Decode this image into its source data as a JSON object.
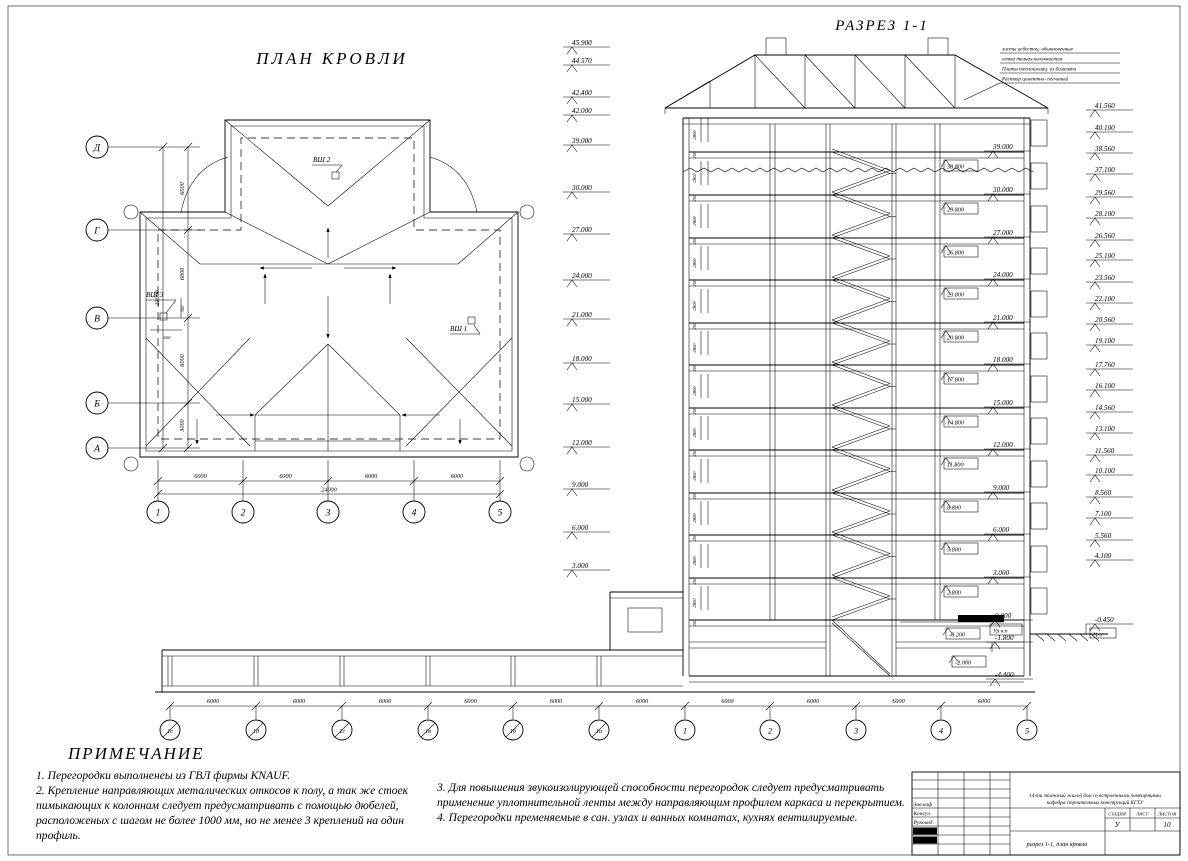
{
  "plan": {
    "title": "ПЛАН КРОВЛИ",
    "axes_left": [
      "Д",
      "Г",
      "В",
      "Б",
      "А"
    ],
    "dims_left": [
      "6000",
      "6000",
      "6000",
      "3000"
    ],
    "total_left": "21000",
    "axes_bottom": [
      "1",
      "2",
      "3",
      "4",
      "5"
    ],
    "dims_bottom": [
      "6000",
      "6000",
      "6000",
      "6000"
    ],
    "total_bottom": "24000",
    "shafts": {
      "vsh1": "ВШ 1",
      "vsh2": "ВШ 2",
      "vsh3": "ВШ 3",
      "dim_300": "300",
      "dim_600": "600"
    }
  },
  "section": {
    "title": "РАЗРЕЗ 1-1",
    "left_marks": [
      "45.900",
      "44.570",
      "42.400",
      "42.000",
      "39.000",
      "30.000",
      "27.000",
      "24.000",
      "21.000",
      "18.000",
      "15.000",
      "12.000",
      "9.000",
      "6.000",
      "3.000"
    ],
    "right_marks": [
      "41.560",
      "40.100",
      "38.560",
      "37.100",
      "29.560",
      "28.100",
      "26.560",
      "25.100",
      "23.560",
      "22.100",
      "20.560",
      "19.100",
      "17.760",
      "16.100",
      "14.560",
      "13.100",
      "11.560",
      "10.100",
      "8.560",
      "7.100",
      "5.560",
      "4.100"
    ],
    "floor_marks": [
      "39.000",
      "30.000",
      "27.000",
      "24.000",
      "21.000",
      "18.000",
      "15.000",
      "12.000",
      "9.000",
      "6.000",
      "3.000"
    ],
    "ceiling_marks": [
      "38.800",
      "29.800",
      "26.800",
      "23.800",
      "20.800",
      "17.800",
      "14.800",
      "11.800",
      "8.800",
      "5.800",
      "2.800"
    ],
    "zero_mark": {
      "value": "0.000",
      "label": "Ур.ч.п"
    },
    "ground_mark": {
      "value": "-0.450",
      "label": "Ур.з"
    },
    "basement_marks": [
      "-0.200",
      "-1.800",
      "-2.000",
      "-4.400"
    ],
    "storey_height": "2800",
    "slab_thickness": "200",
    "roof_note_lines": [
      "листы асбестоц. обыкновенные",
      "сетка тканая волокнистая",
      "Плиты теплоизоляц. из базальта",
      "Раствор цементно- песчаный"
    ],
    "axes_secondary": [
      "1е",
      "1д",
      "1г",
      "1в",
      "1б",
      "1а"
    ],
    "axes_main": [
      "1",
      "2",
      "3",
      "4",
      "5"
    ],
    "dims_bottom": [
      "6000",
      "6000",
      "6000",
      "6000",
      "6000",
      "6000",
      "6000",
      "6000",
      "6000",
      "6000"
    ]
  },
  "notes": {
    "heading": "ПРИМЕЧАНИЕ",
    "left": "1. Перегородки выполненеы из ГВЛ фирмы KNAUF.\n2. Крепление направляющих металических откосов к полу, а так же стоек\nпимыкающих к колоннам следует предусматривать с помощью дюбелей,\nрасположеных с шагом не более 1000 мм, но не менее  3 креплений на один\nпрофиль.",
    "right": "3. Для повышения звукоизолирующей способности перегородок следует предусматривать\nприменение уплотнительной ленты между направляющим профилем каркаса и перекрытием.\n4. Перегородки пременяемые в сан. узлах и ванных комнатах, кухнях вентилируемые."
  },
  "title_block": {
    "roles": [
      "Зав.каф",
      "Консул.",
      "Руковод."
    ],
    "project_line1": "14-ти этажный жилой дом со встроенными помещениями",
    "project_line2": "кафедра строительных конструкций КГТУ",
    "stage_label": "СТАДИЯ",
    "sheet_label": "ЛИСТ",
    "sheets_label": "ЛИСТОВ",
    "stage": "У",
    "sheet": "",
    "sheets": "10",
    "doc_title": "разрез 1-1, план кровли"
  }
}
